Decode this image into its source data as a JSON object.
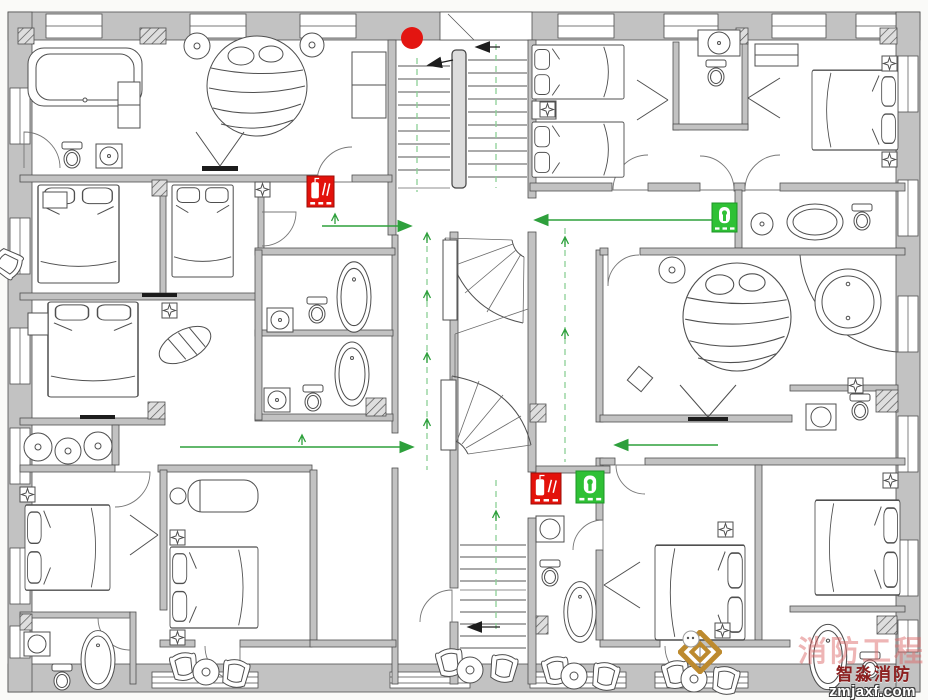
{
  "watermark": {
    "background_text": "消防工程",
    "brand_text": "智淼消防",
    "url_text": "zmjaxf.com"
  },
  "colors": {
    "evacuation_green": "#2ea03c",
    "route_dash_green": "#8ccf96",
    "extinguisher_red": "#e3120b",
    "hydrant_green": "#2fc135",
    "fire_dot_red": "#e31511",
    "wall_gray": "#c2c2c2",
    "watermark_pink": "rgba(222,108,108,0.5)",
    "brand_red": "#8c1f1f",
    "logo_gold": "#bd8a2e"
  },
  "fire_origin_dot": {
    "x": 412,
    "y": 38,
    "r": 11
  },
  "safety_markers": [
    {
      "name": "fire-extinguisher-sign",
      "x": 307,
      "y": 176,
      "w": 27,
      "h": 31
    },
    {
      "name": "fire-extinguisher-sign",
      "x": 531,
      "y": 473,
      "w": 30,
      "h": 31
    },
    {
      "name": "fire-hydrant-sign",
      "x": 576,
      "y": 471,
      "w": 28,
      "h": 32
    },
    {
      "name": "fire-hydrant-sign",
      "x": 712,
      "y": 203,
      "w": 25,
      "h": 29
    }
  ],
  "evacuation_routes": {
    "arrows": [
      {
        "points": [
          [
            322,
            226
          ],
          [
            410,
            226
          ]
        ]
      },
      {
        "points": [
          [
            726,
            220
          ],
          [
            536,
            220
          ]
        ]
      },
      {
        "points": [
          [
            180,
            447
          ],
          [
            412,
            447
          ]
        ]
      },
      {
        "points": [
          [
            718,
            445
          ],
          [
            616,
            445
          ]
        ]
      }
    ],
    "stair_arrows": [
      {
        "points": [
          [
            453,
            60
          ],
          [
            429,
            65
          ]
        ]
      },
      {
        "points": [
          [
            500,
            47
          ],
          [
            477,
            47
          ]
        ]
      },
      {
        "points": [
          [
            500,
            627
          ],
          [
            469,
            627
          ]
        ]
      }
    ],
    "dashes": [
      {
        "x1": 417,
        "y1": 58,
        "x2": 417,
        "y2": 192
      },
      {
        "x1": 496,
        "y1": 44,
        "x2": 496,
        "y2": 188
      },
      {
        "x1": 427,
        "y1": 235,
        "x2": 427,
        "y2": 470
      },
      {
        "x1": 565,
        "y1": 228,
        "x2": 565,
        "y2": 462
      },
      {
        "x1": 496,
        "y1": 480,
        "x2": 496,
        "y2": 632
      }
    ],
    "ticks": [
      [
        427,
        238
      ],
      [
        427,
        296
      ],
      [
        427,
        358
      ],
      [
        427,
        424
      ],
      [
        565,
        242
      ],
      [
        565,
        334
      ],
      [
        496,
        516
      ],
      [
        302,
        440
      ],
      [
        335,
        219
      ]
    ]
  }
}
